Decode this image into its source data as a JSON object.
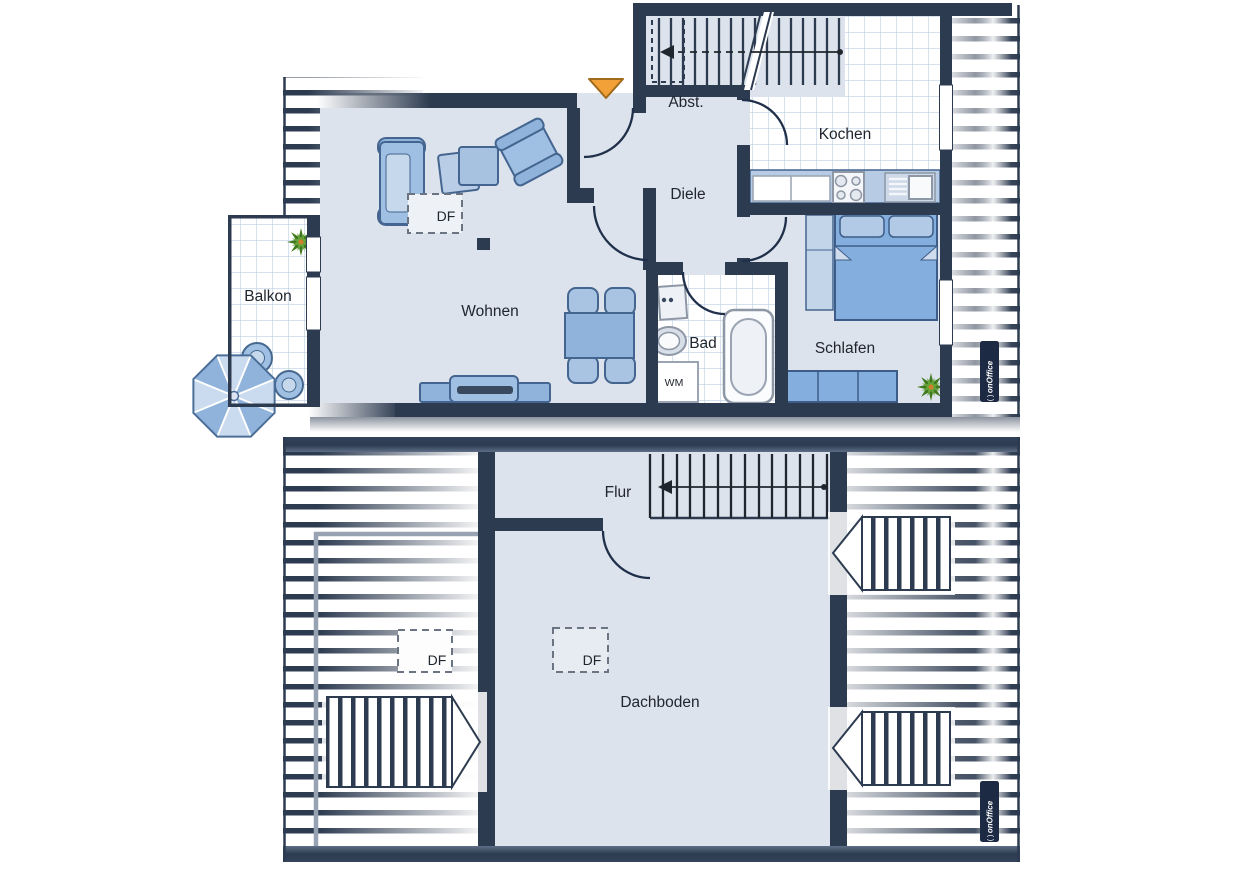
{
  "floor1": {
    "labels": {
      "balkon": "Balkon",
      "wohnen": "Wohnen",
      "diele": "Diele",
      "abst": "Abst.",
      "kochen": "Kochen",
      "bad": "Bad",
      "schlafen": "Schlafen"
    },
    "df": "DF",
    "wm": "WM"
  },
  "floor2": {
    "labels": {
      "flur": "Flur",
      "dachboden": "Dachboden"
    },
    "df_roof": "DF",
    "df_room": "DF"
  },
  "watermark": {
    "brand": "onOffice",
    "mark": "( )"
  },
  "colors": {
    "wall": "#2d3b50",
    "floor": "#dde3ed",
    "tile_line": "#bccfe3",
    "furniture": "#8fb3da",
    "furniture_light": "#c3d5e9",
    "bed": "#84aedd",
    "accent_orange": "#f2a139",
    "plant_green": "#67a33a",
    "badge_bg": "#1c2a44"
  }
}
